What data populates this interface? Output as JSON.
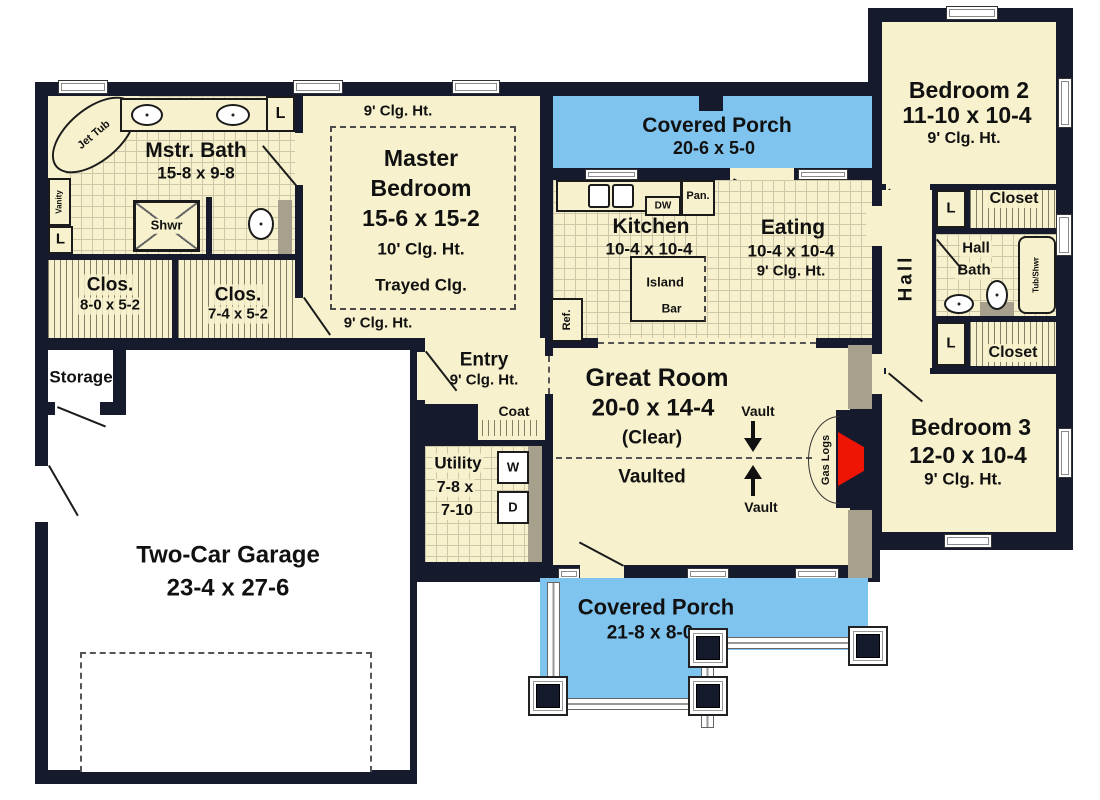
{
  "palette": {
    "wall": "#151a2c",
    "floor": "#f7f2cd",
    "porch": "#7fc4ef",
    "fireplace_red": "#ee1505",
    "fixture_gray": "#a6a08d"
  },
  "master_bath": {
    "name": "Mstr. Bath",
    "dims": "15-8 x 9-8",
    "jet_tub": "Jet Tub",
    "vanity": "Vanity",
    "linen_top": "L",
    "linen_bottom": "L",
    "shower": "Shwr"
  },
  "closet1": {
    "name": "Clos.",
    "dims": "8-0 x 5-2"
  },
  "closet2": {
    "name": "Clos.",
    "dims": "7-4 x 5-2"
  },
  "master_bedroom": {
    "name1": "Master",
    "name2": "Bedroom",
    "dims": "15-6 x 15-2",
    "clg": "10' Clg. Ht.",
    "tray": "Trayed Clg.",
    "clg_top": "9' Clg. Ht.",
    "clg_bottom": "9' Clg. Ht."
  },
  "porch_top": {
    "name": "Covered Porch",
    "dims": "20-6 x 5-0"
  },
  "kitchen": {
    "name": "Kitchen",
    "dims": "10-4 x 10-4",
    "dw": "DW",
    "pan": "Pan.",
    "ref": "Ref.",
    "island": "Island",
    "bar": "Bar"
  },
  "eating": {
    "name": "Eating",
    "dims": "10-4 x 10-4",
    "clg": "9' Clg. Ht."
  },
  "bedroom2": {
    "name": "Bedroom 2",
    "dims": "11-10 x 10-4",
    "clg": "9' Clg. Ht."
  },
  "hall": {
    "name": "Hall",
    "linen_top": "L",
    "linen_bottom": "L"
  },
  "closet_top": {
    "name": "Closet"
  },
  "closet_bottom": {
    "name": "Closet"
  },
  "hall_bath": {
    "name1": "Hall",
    "name2": "Bath",
    "tub": "Tub/Shwr"
  },
  "bedroom3": {
    "name": "Bedroom 3",
    "dims": "12-0 x 10-4",
    "clg": "9' Clg. Ht."
  },
  "great_room": {
    "name": "Great Room",
    "dims": "20-0 x 14-4",
    "clear": "(Clear)",
    "vaulted": "Vaulted",
    "vault_top": "Vault",
    "vault_bottom": "Vault",
    "gas_logs": "Gas Logs"
  },
  "entry": {
    "name": "Entry",
    "clg": "9' Clg. Ht."
  },
  "coat": {
    "name": "Coat"
  },
  "utility": {
    "name": "Utility",
    "dims1": "7-8 x",
    "dims2": "7-10",
    "washer": "W",
    "dryer": "D"
  },
  "storage": {
    "name": "Storage"
  },
  "garage": {
    "name": "Two-Car Garage",
    "dims": "23-4 x 27-6"
  },
  "porch_bottom": {
    "name": "Covered Porch",
    "dims": "21-8 x 8-0"
  }
}
